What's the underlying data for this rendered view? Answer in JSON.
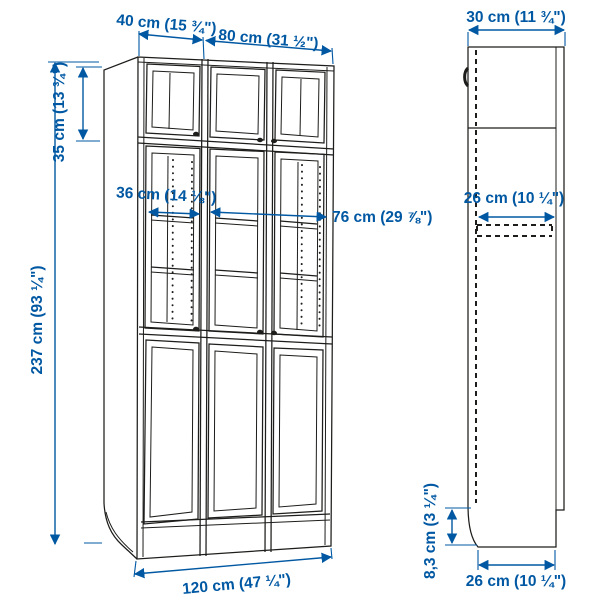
{
  "page": {
    "title": "Bookcase combination with doors – dimension diagram",
    "background": "#ffffff"
  },
  "colors": {
    "dimension_blue": "#0058a3",
    "outline_black": "#1d1d1b"
  },
  "views": {
    "front": "front-view",
    "side": "side-view"
  },
  "labels": {
    "left_unit_width": "40 cm (15 ¾\")",
    "right_unit_width": "80 cm (31 ½\")",
    "depth_top": "30 cm (11 ¾\")",
    "extension_height": "35 cm (13 ¾\")",
    "total_height": "237 cm (93 ¼\")",
    "interior_width_left": "36 cm (14 ⅛\")",
    "interior_width_right": "76 cm (29 ⅞\")",
    "shelf_depth": "26 cm (10 ¼\")",
    "plinth_height": "8,3 cm (3 ¼\")",
    "total_width": "120 cm (47 ¼\")",
    "base_depth": "26 cm (10 ¼\")"
  }
}
